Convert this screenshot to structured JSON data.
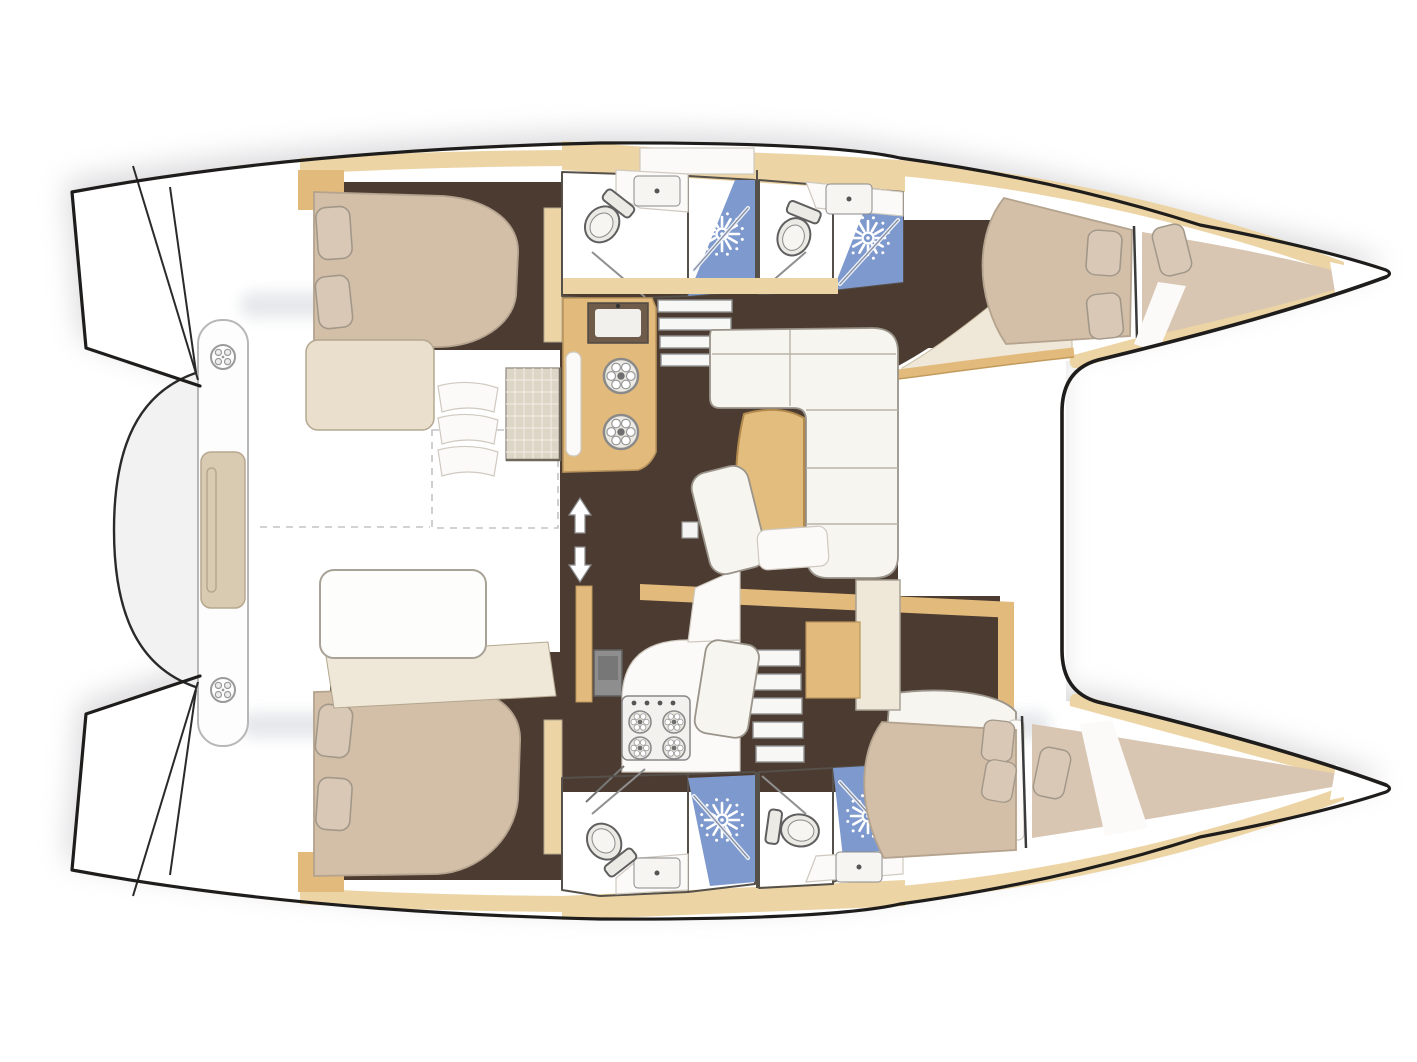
{
  "diagram": {
    "title": "Catamaran sailing yacht interior layout – top view floor plan",
    "type": "boat-floor-plan",
    "orientation": {
      "bow": "right",
      "stern": "left"
    },
    "areas": {
      "port_hull": {
        "label": "Port hull (top)",
        "spaces": [
          "aft double cabin",
          "aft bathroom with shower",
          "forward bathroom with shower",
          "forward double cabin",
          "bow crew berth"
        ]
      },
      "starboard_hull": {
        "label": "Starboard hull (bottom)",
        "spaces": [
          "aft double cabin",
          "galley with stove and oven",
          "aft bathroom with shower",
          "forward bathroom with shower",
          "forward double cabin",
          "bow crew berth"
        ]
      },
      "saloon": {
        "label": "Saloon and galley-up counter",
        "spaces": [
          "galley counter with sink and two basins",
          "L-shaped sofa",
          "curved table",
          "movable bench",
          "companionway steps"
        ]
      },
      "cockpit": {
        "label": "Aft cockpit",
        "spaces": [
          "bench seats",
          "grating table",
          "curved slat seat"
        ]
      },
      "foredeck": {
        "label": "Foredeck and trampoline",
        "spaces": [
          "trampoline opening between bows"
        ]
      },
      "stern_platform": {
        "label": "Stern crossbeam platform",
        "spaces": [
          "transom crossbar",
          "deck fittings",
          "davit pod"
        ]
      }
    },
    "features": {
      "double_berths": 4,
      "bow_crew_berths": 2,
      "bathrooms": 4,
      "shower_stalls": 4,
      "toilets": 4,
      "washbasins": 4,
      "galley_round_basins": 2,
      "stove_burners": 4,
      "companionway_stairs": 2,
      "saloon_sofa_shape": "L",
      "deck_fittings": 2
    }
  },
  "icons": {
    "shower_head": "sunburst-rays-icon",
    "toilet": "toilet-top-view-icon",
    "washbasin": "rounded-rectangle-basin-icon",
    "burner": "ring-with-petals-icon",
    "deck_fitting": "circle-cleat-icon",
    "direction_arrows": "up-down-arrows-icon"
  },
  "colors": {
    "outline": "#1f1d1b",
    "wall": "#55504a",
    "line": "#9a948a",
    "deck_white": "#ffffff",
    "deck_shade": "#dde0e4",
    "shadow": "#aeaeb4",
    "floor_brown": "#4c3b31",
    "wood_light": "#ecd4a4",
    "wood_mid": "#e2ba7c",
    "bed_tan": "#d3bea7",
    "bed_tan_light": "#d8c6b2",
    "pillow": "#d9c8b5",
    "cushion": "#f7f5f0",
    "cream": "#efe7d7",
    "bath_light": "#b6c4e3",
    "bath_mid": "#93abd8",
    "bath_deep": "#7e99cd",
    "table_tan": "#e3bd7e"
  }
}
